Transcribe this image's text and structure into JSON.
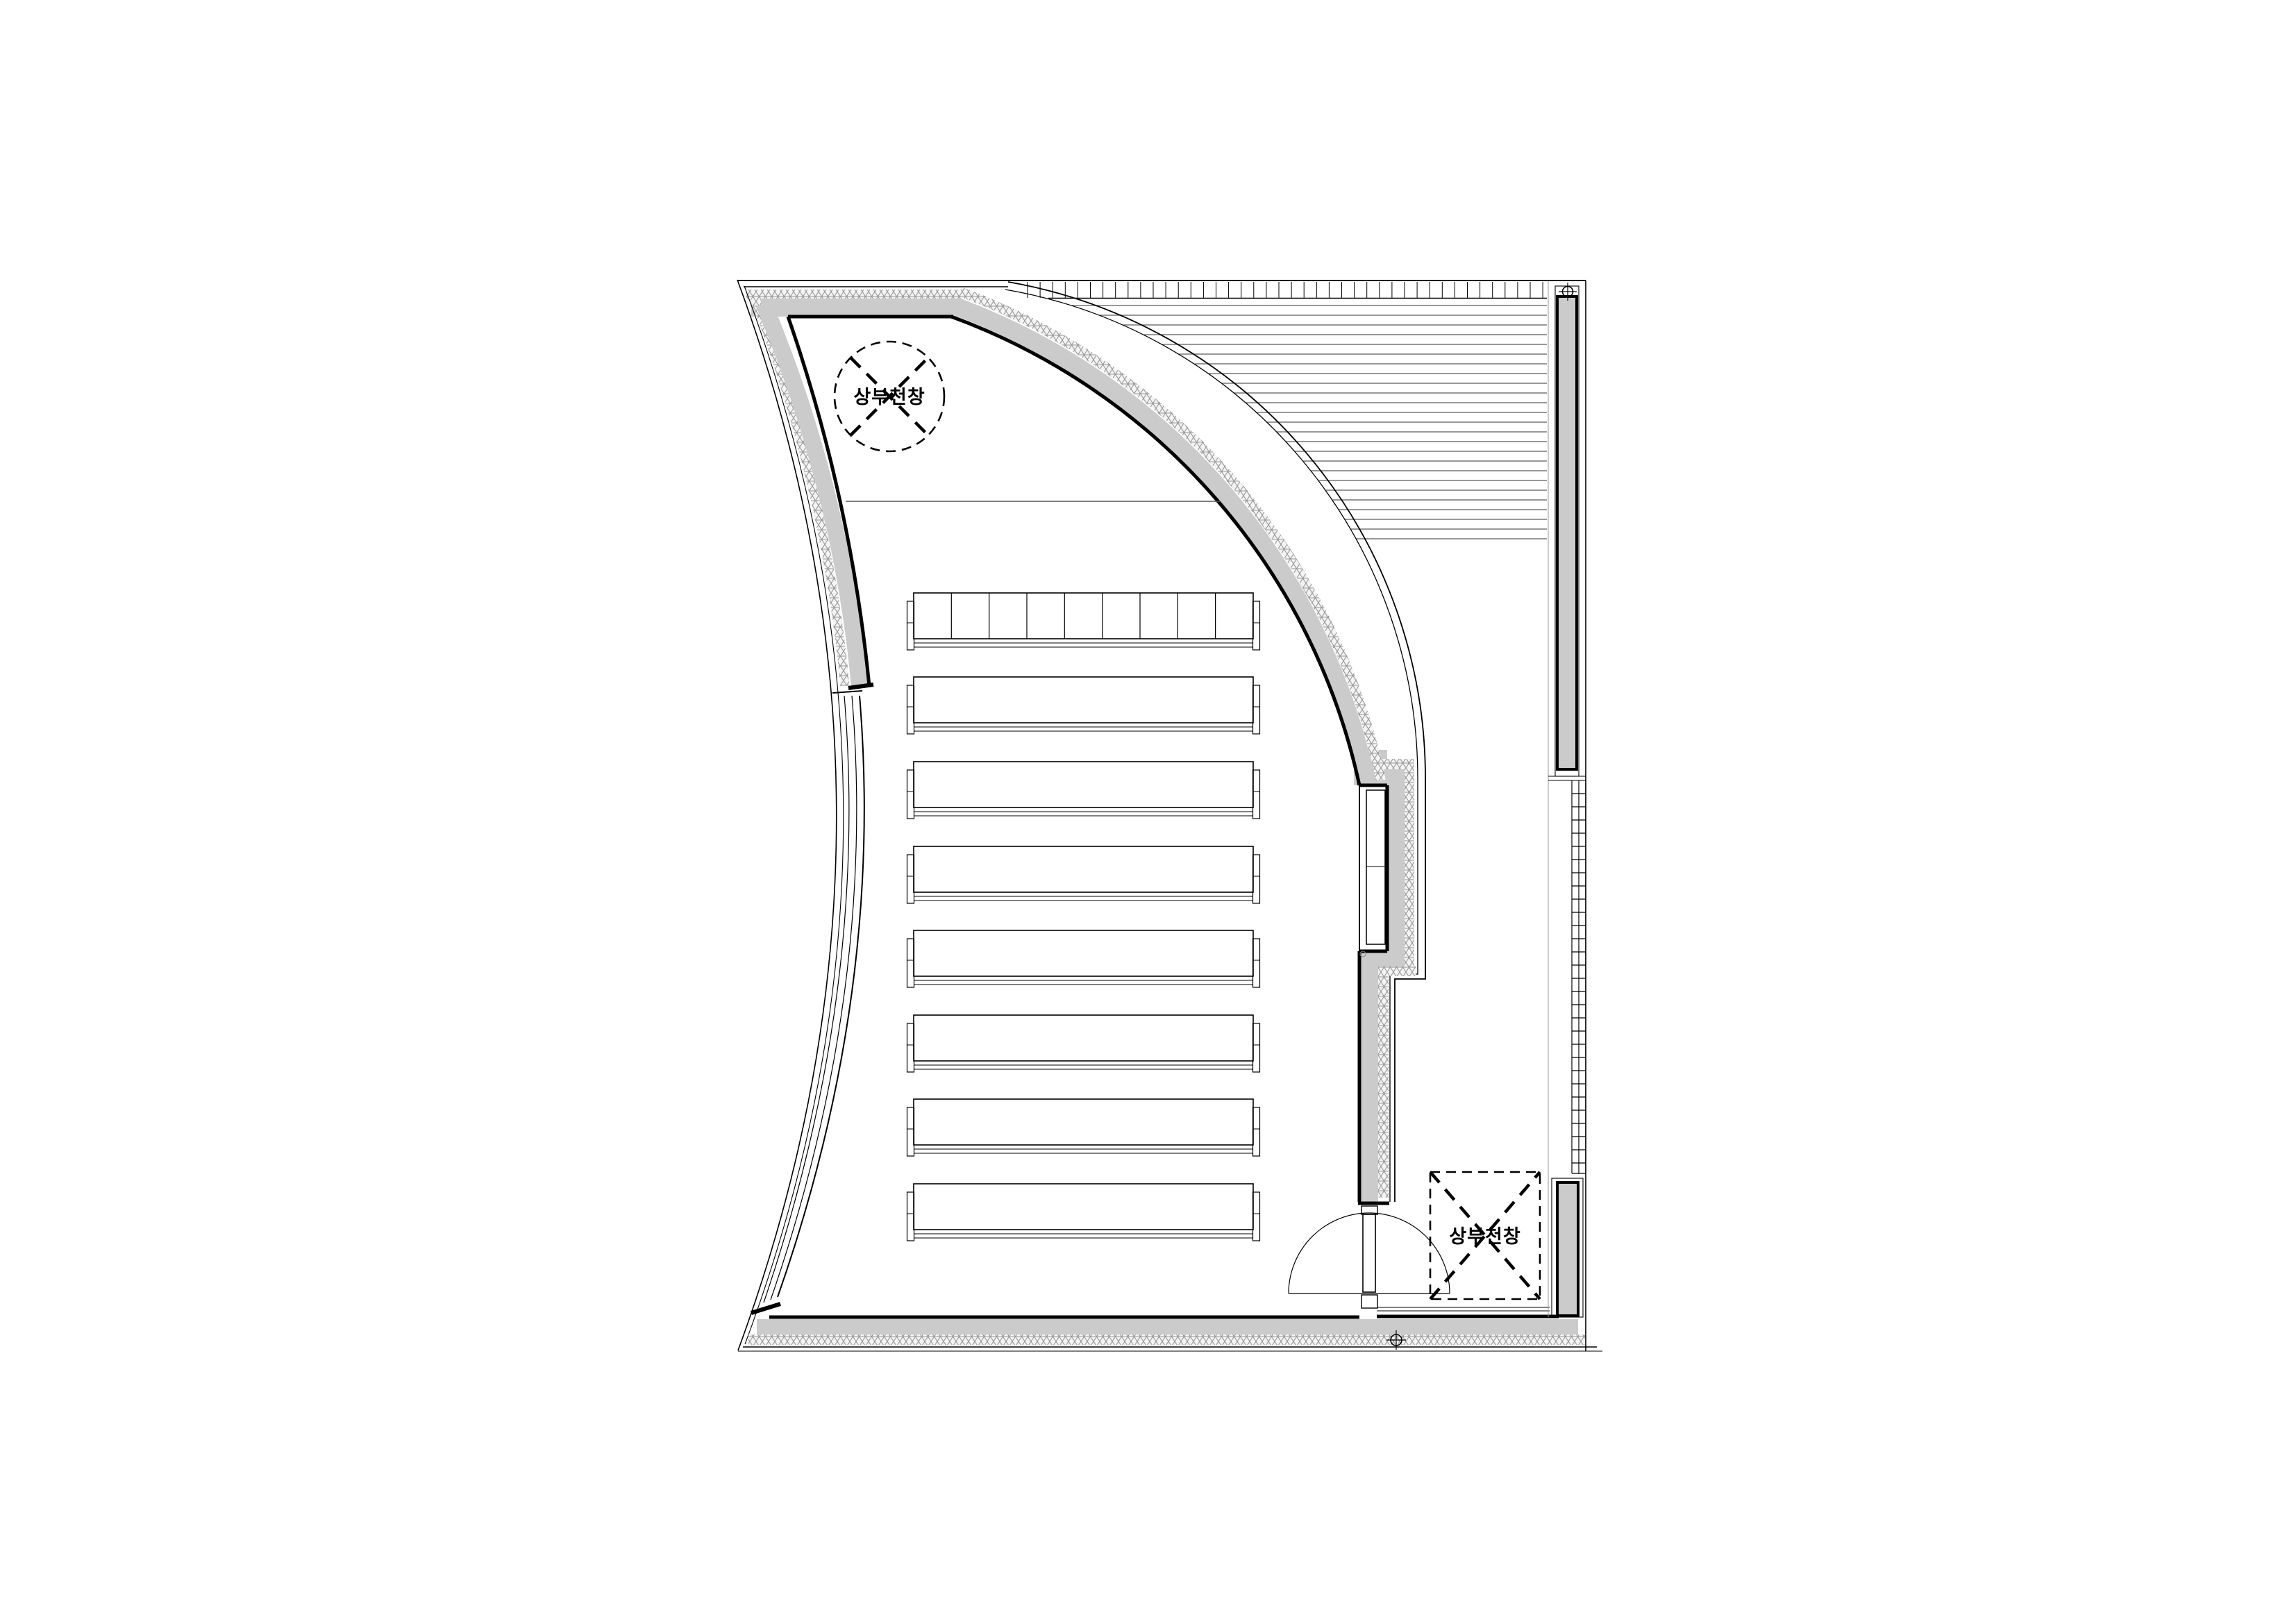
{
  "page": {
    "background": "#ffffff"
  },
  "drawing": {
    "type": "architectural-floor-plan",
    "language": "ko",
    "annotations": {
      "skylight_circle_label": "상부천창",
      "skylight_square_label": "상부천창"
    },
    "colors": {
      "wall_fill": "#cbcbcb",
      "line": "#000000",
      "hatch_line": "#979797",
      "louver_line": "#777777",
      "light_line": "#999999"
    },
    "counts": {
      "bench_rows": 8,
      "front_row_seat_sections": 9,
      "skylights": 2,
      "doors": 1,
      "survey_markers": 2
    }
  }
}
